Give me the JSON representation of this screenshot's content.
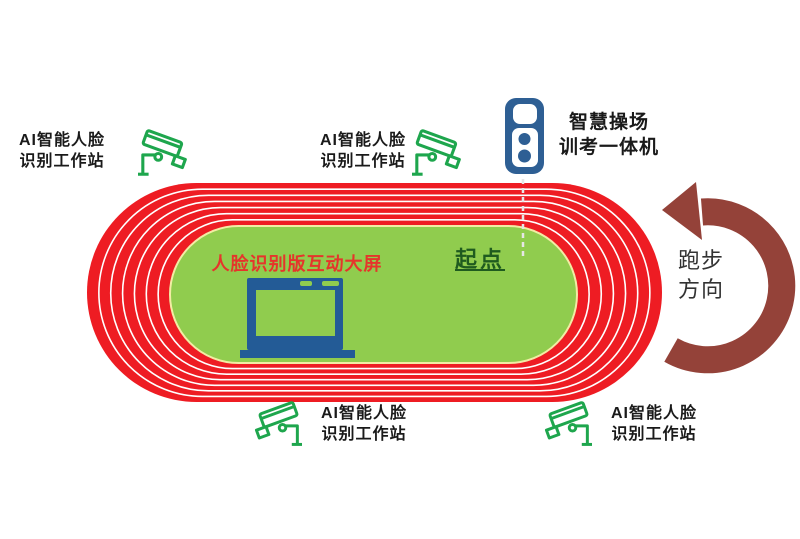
{
  "canvas": {
    "width": 800,
    "height": 539
  },
  "colors": {
    "track_red": "#EE1C23",
    "field_green": "#90CC4E",
    "lane_line": "#FFFFFF",
    "field_border": "#F2ECA4",
    "camera_green": "#1EA64D",
    "device_blue": "#2E5F94",
    "laptop_blue": "#235B96",
    "arrow_red": "#944239",
    "field_label_red": "#E5352B",
    "start_green": "#1F5B1F",
    "label_black": "#1A1A1A",
    "direction_text": "#333333",
    "start_line_dash": "#E6E6E6"
  },
  "track": {
    "lane_count": 7,
    "outer": {
      "x": 87,
      "y": 183,
      "w": 575,
      "h": 219
    },
    "inner": {
      "x": 170,
      "y": 226,
      "w": 407,
      "h": 137
    }
  },
  "stations": [
    {
      "id": "top-left",
      "lines": [
        "AI智能人脸",
        "识别工作站"
      ]
    },
    {
      "id": "top-middle",
      "lines": [
        "AI智能人脸",
        "识别工作站"
      ]
    },
    {
      "id": "bottom-middle",
      "lines": [
        "AI智能人脸",
        "识别工作站"
      ]
    },
    {
      "id": "bottom-right",
      "lines": [
        "AI智能人脸",
        "识别工作站"
      ]
    }
  ],
  "kiosk": {
    "label_lines": [
      "智慧操场",
      "训考一体机"
    ]
  },
  "field": {
    "screen_label": "人脸识别版互动大屏",
    "start_label": "起点"
  },
  "direction": {
    "lines": [
      "跑步",
      "方向"
    ]
  },
  "icons": [
    "cctv-camera-icon",
    "kiosk-icon",
    "laptop-icon",
    "curved-arrow-icon",
    "start-dashed-line"
  ]
}
